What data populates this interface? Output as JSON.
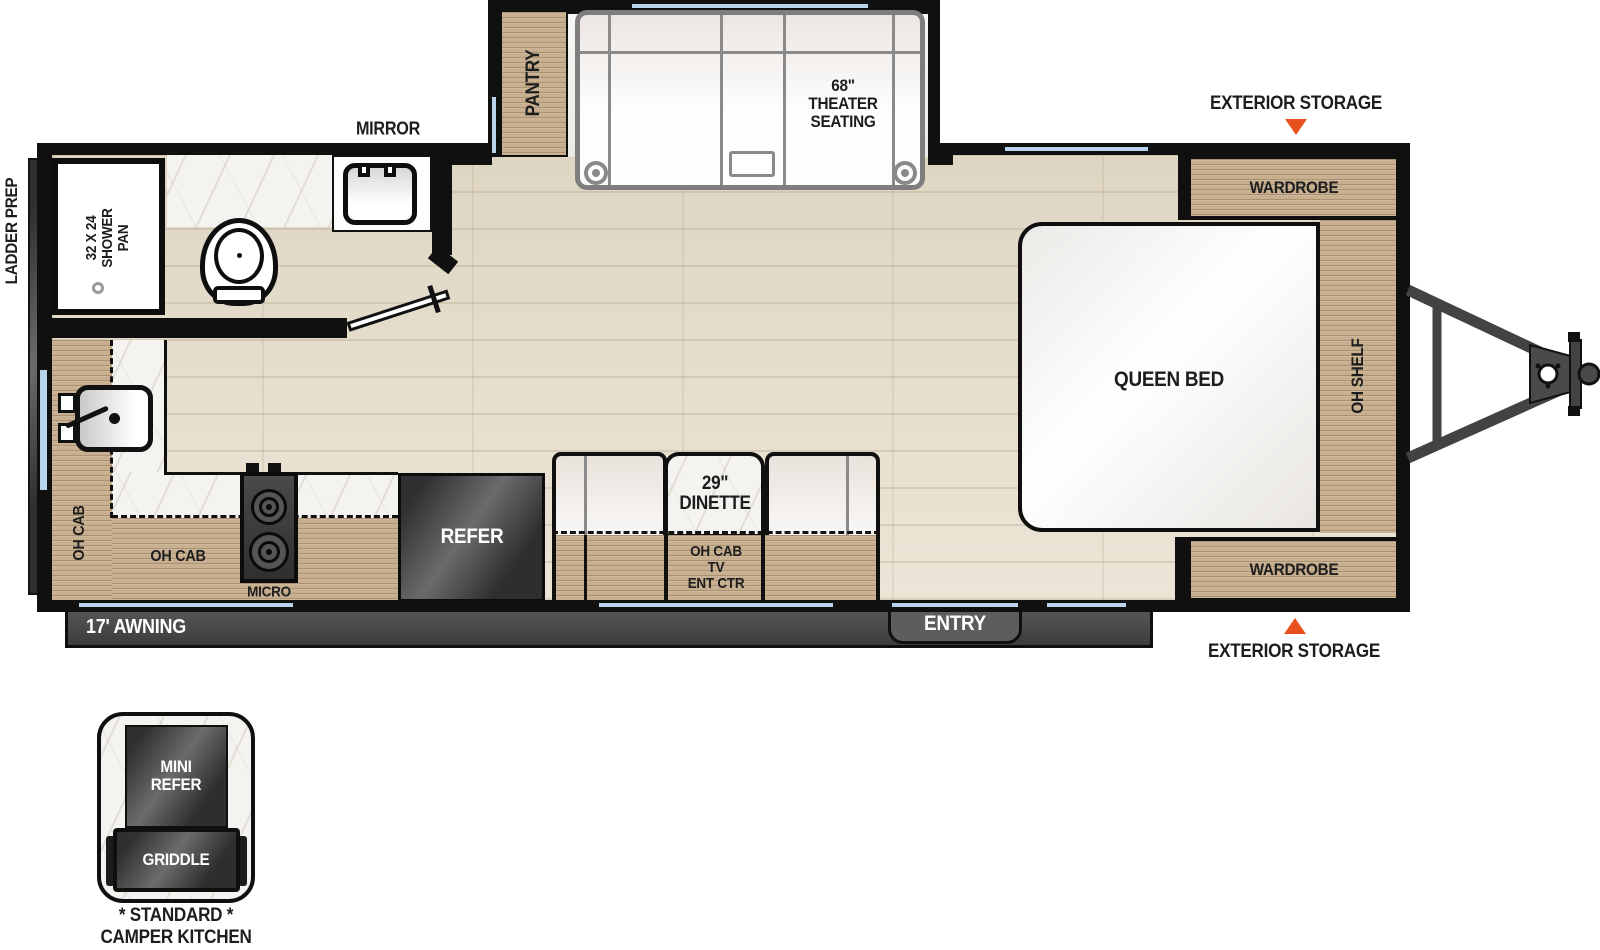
{
  "labels": {
    "ladder_prep": "LADDER PREP",
    "mirror": "MIRROR",
    "exterior_storage_top": "EXTERIOR STORAGE",
    "exterior_storage_bottom": "EXTERIOR STORAGE"
  },
  "bathroom": {
    "shower_line1": "32 X 24",
    "shower_line2": "SHOWER",
    "shower_line3": "PAN"
  },
  "slideout": {
    "pantry": "PANTRY",
    "theater_line1": "68\"",
    "theater_line2": "THEATER",
    "theater_line3": "SEATING"
  },
  "bedroom": {
    "queen_bed": "QUEEN BED",
    "oh_shelf": "OH SHELF",
    "wardrobe_top": "WARDROBE",
    "wardrobe_bottom": "WARDROBE"
  },
  "kitchen": {
    "oh_cab_left": "OH CAB",
    "oh_cab_bottom": "OH CAB",
    "micro": "MICRO",
    "refer": "REFER"
  },
  "dinette": {
    "size": "29\"",
    "name": "DINETTE",
    "below_line1": "OH CAB",
    "below_line2": "TV",
    "below_line3": "ENT CTR"
  },
  "exterior": {
    "entry": "ENTRY",
    "awning": "17' AWNING"
  },
  "camper_kitchen": {
    "mini_refer_line1": "MINI",
    "mini_refer_line2": "REFER",
    "griddle": "GRIDDLE",
    "standard": "* STANDARD *",
    "title": "CAMPER KITCHEN"
  },
  "colors": {
    "accent_orange": "#E8501E",
    "window_blue": "#B7D4EC",
    "wood_tan": "#C7AF8F",
    "appliance_dark": "#3A3A3A",
    "wall_black": "#101010"
  }
}
